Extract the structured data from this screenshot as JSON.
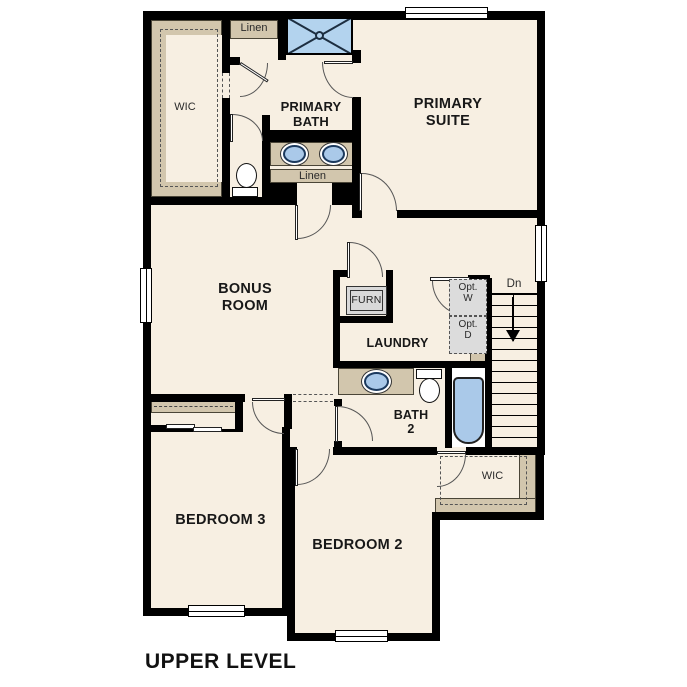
{
  "page": {
    "title": "UPPER LEVEL"
  },
  "labels": {
    "wic_top": "WIC",
    "linen_top": "Linen",
    "primary_bath": [
      "PRIMARY",
      "BATH"
    ],
    "primary_suite": [
      "PRIMARY",
      "SUITE"
    ],
    "bonus_room": [
      "BONUS",
      "ROOM"
    ],
    "linen_mid": "Linen",
    "furnace": "FURN",
    "laundry": "LAUNDRY",
    "opt_washer": [
      "Opt.",
      "W"
    ],
    "opt_dryer": [
      "Opt.",
      "D"
    ],
    "stairs_dn": "Dn",
    "bath2": [
      "BATH",
      "2"
    ],
    "bedroom3": "BEDROOM 3",
    "bedroom2": "BEDROOM 2",
    "wic_bottom": "WIC"
  },
  "colors": {
    "background": "#ffffff",
    "floor": "#f7efe2",
    "wall": "#000000",
    "closet_tan": "#d2c6ad",
    "fixture_blue": "#aac9e9",
    "shower_blue": "#b3d3ee",
    "appliance_gray": "#d9d9d9"
  }
}
